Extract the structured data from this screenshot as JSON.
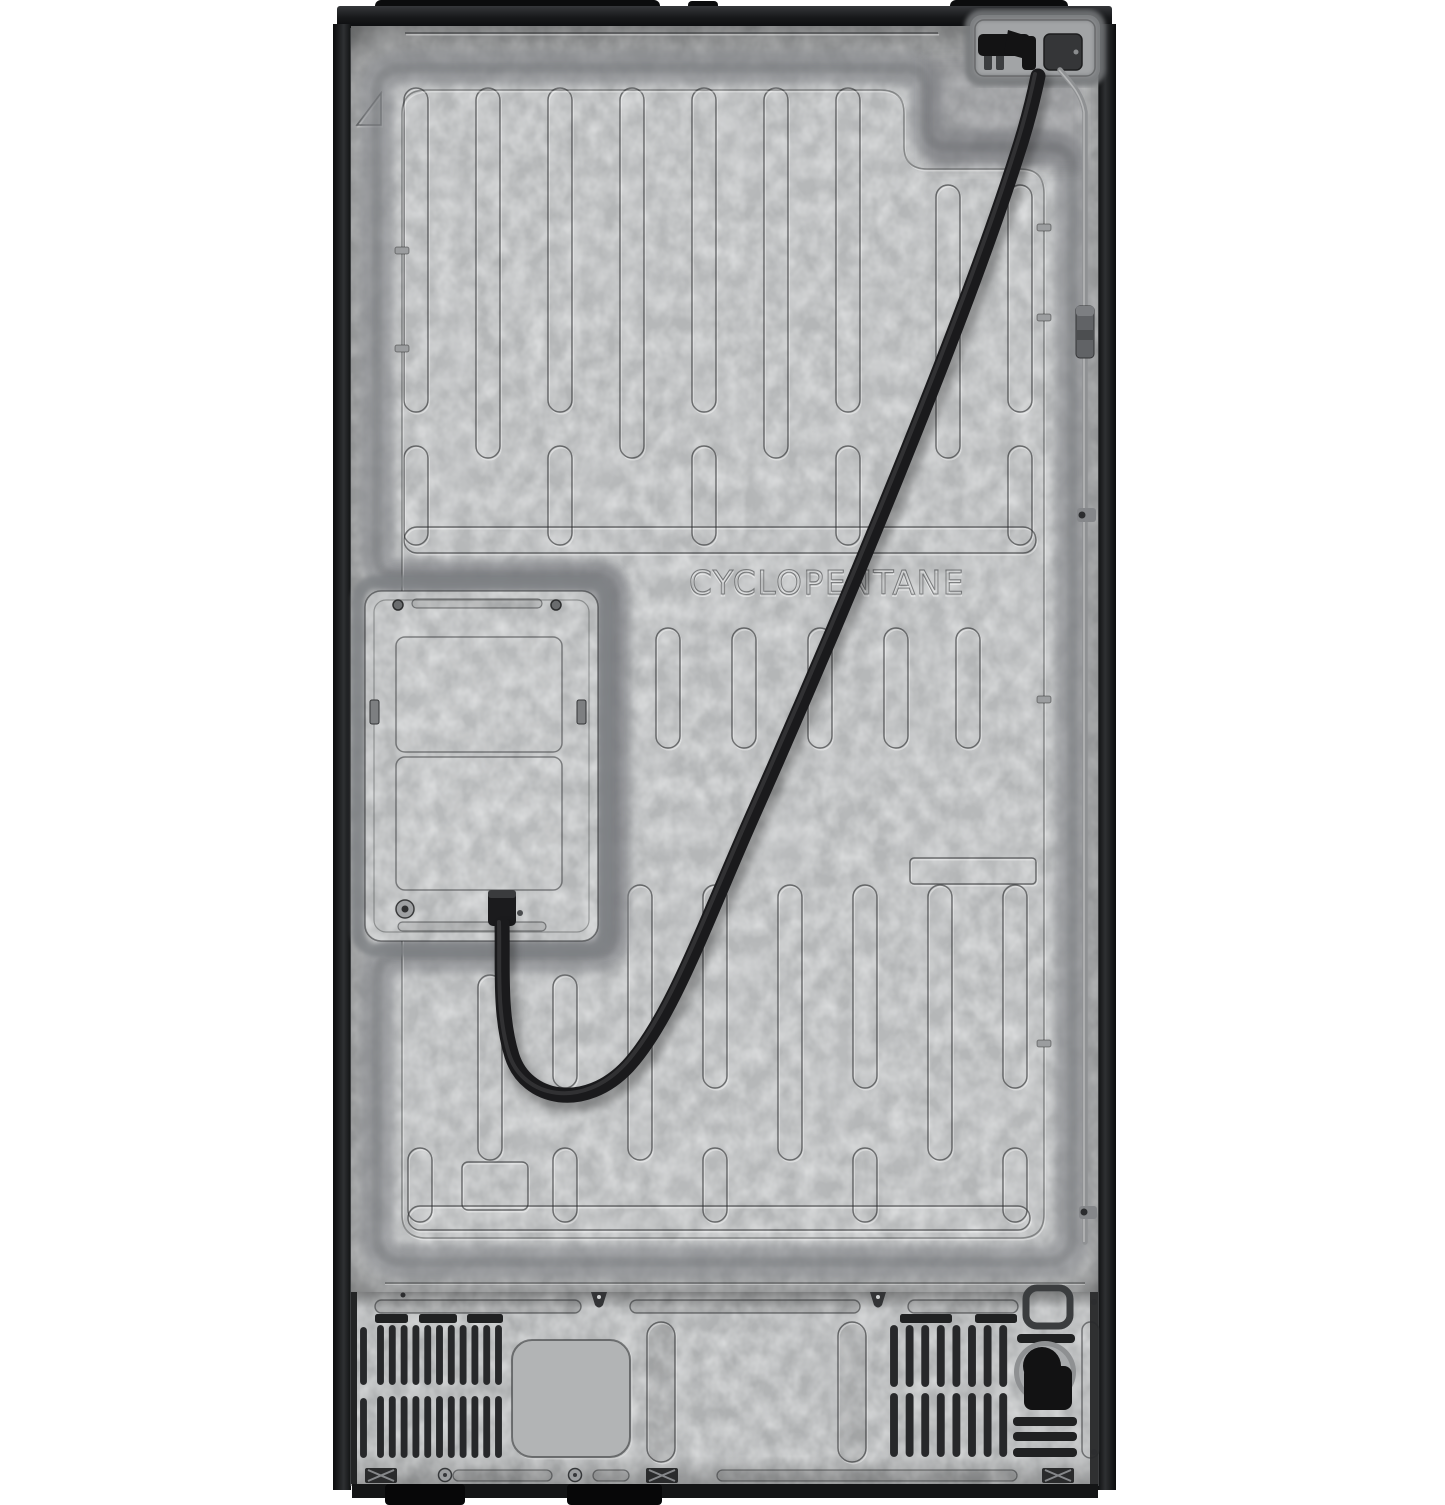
{
  "image": {
    "description": "Rear view product photo of a refrigerator: galvanized steel back panel with embossed ribs, service access panel, power cord, water line and vented machine-compartment cover",
    "background_color": "#ffffff"
  },
  "panel": {
    "embossed_text": "CYCLOPENTANE"
  },
  "colors": {
    "galvanized_base": "#b4b6b7",
    "machine_plate": "#aeb0b1",
    "recess_shadow": "#84868a",
    "cabinet_trim": "#141516",
    "power_cord": "#1a1a1c",
    "water_tube": "#8f9193",
    "vent_slot": "#28292b"
  }
}
